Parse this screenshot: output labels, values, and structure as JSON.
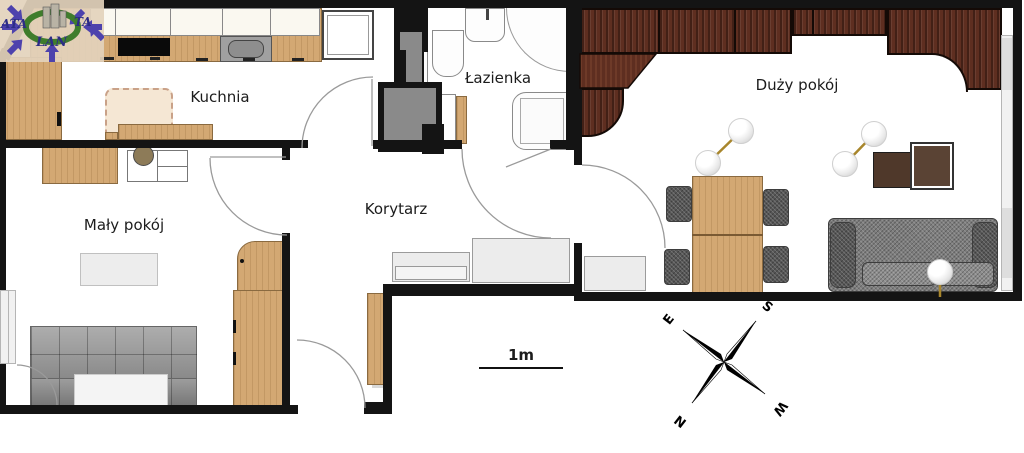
{
  "logo": {
    "part1": "ATA",
    "part2": "TA",
    "part3": "LAN"
  },
  "rooms": {
    "kitchen": {
      "label": "Kuchnia"
    },
    "bathroom": {
      "label": "Łazienka"
    },
    "living_room": {
      "label": "Duży pokój"
    },
    "small_room": {
      "label": "Mały pokój"
    },
    "corridor": {
      "label": "Korytarz"
    }
  },
  "scale_bar": {
    "label": "1m"
  },
  "compass": {
    "north": "N",
    "south": "S",
    "east": "E",
    "west": "W"
  },
  "palette": {
    "wall": "#141414",
    "light_wood": "#d3a873",
    "dark_wood": "#5e2e20",
    "sofa_gray": "#7d7d7d",
    "cabinet_gray": "#ececec",
    "shaft_gray": "#8a8a8a",
    "lamp_gold": "#a8862c",
    "logo_purple": "#4d42ad",
    "logo_green": "#3f7d2c"
  }
}
